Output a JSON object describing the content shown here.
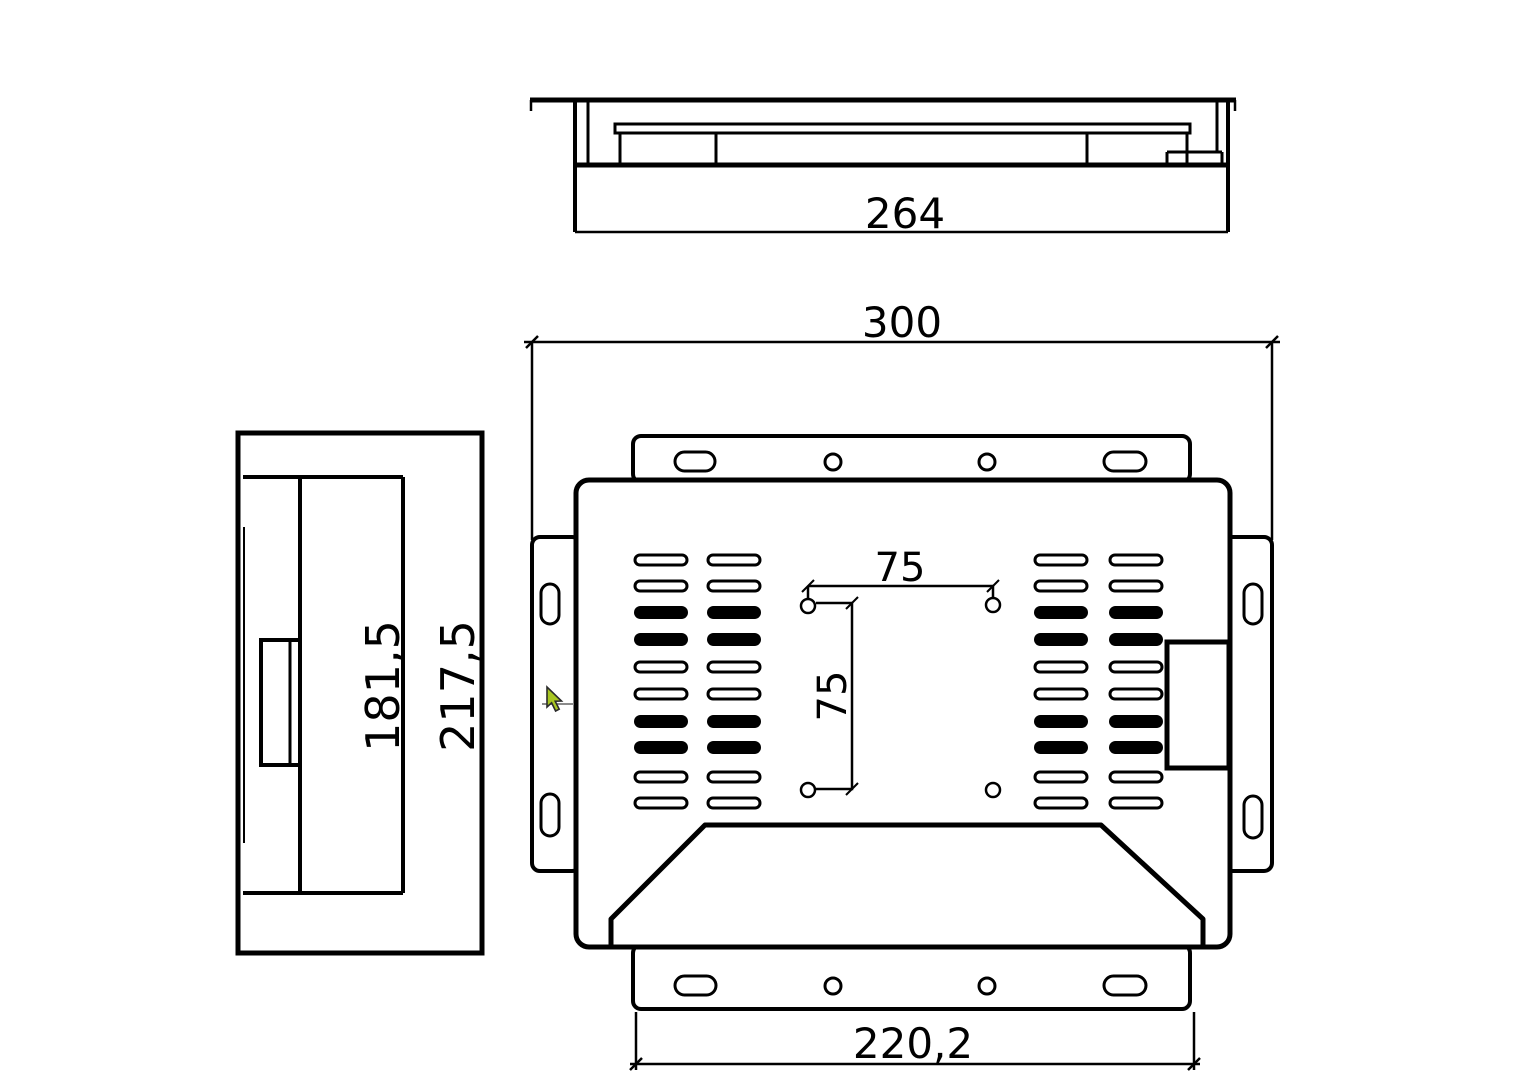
{
  "drawing": {
    "background_color": "#ffffff",
    "line_color": "#000000"
  },
  "top_view": {
    "dim_width": "264"
  },
  "rear_view": {
    "dim_overall_width": "300",
    "dim_vesa_horizontal": "75",
    "dim_vesa_vertical": "75",
    "dim_bottom_bracket_width": "220,2"
  },
  "side_view": {
    "dim_body_height": "181,5",
    "dim_overall_height": "217,5"
  },
  "cursor": {
    "kind": "arrow",
    "fill": "#a8c622",
    "outline": "#2b2b2b"
  }
}
